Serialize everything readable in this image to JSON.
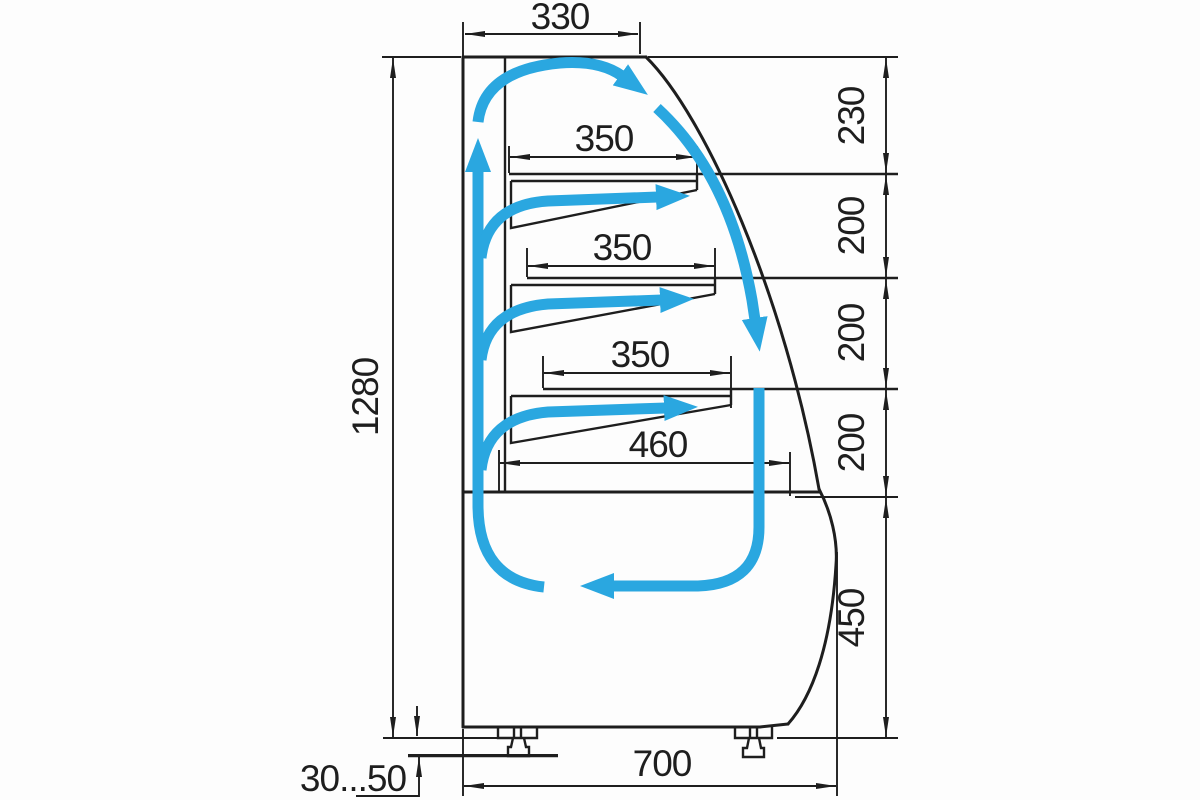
{
  "drawing": {
    "description": "Side cross-section technical drawing of a curved-glass refrigerated pastry display case with blue air-circulation arrows and dimension callouts",
    "colors": {
      "line": "#1e1e1e",
      "airflow": "#2aa7e0",
      "background": "#fdfdfd"
    },
    "dimensions": {
      "top_width": "330",
      "shelf_widths": [
        "350",
        "350",
        "350"
      ],
      "base_shelf_width": "460",
      "overall_height": "1280",
      "right_sections": [
        "230",
        "200",
        "200",
        "200",
        "450"
      ],
      "overall_depth": "700",
      "leg_height_range": "30...50"
    }
  }
}
